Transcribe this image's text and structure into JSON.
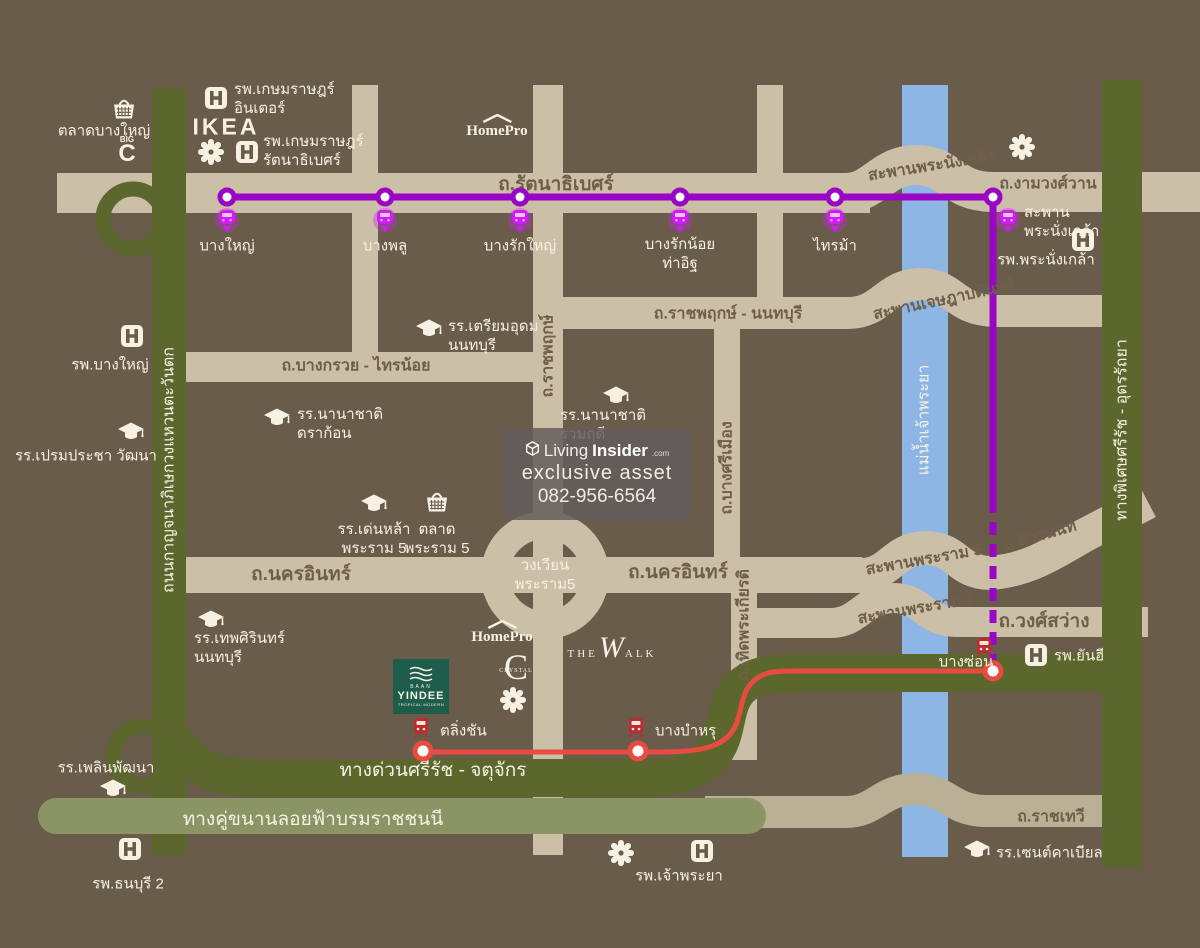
{
  "map": {
    "colors": {
      "bg": "#6a5c4b",
      "road_tan": "#cbc0a7",
      "road_label": "#6e5f4b",
      "green_dark": "#5c672d",
      "green_light": "#8a9465",
      "tan_bridge": "#b9b096",
      "river": "#8db6e5",
      "purple": "#9b05c6",
      "magenta": "#cf1df2",
      "red": "#e84b40",
      "red_dark": "#bf2a2e",
      "white": "#f7f1e4",
      "yindee": "#1e5c4b"
    },
    "watermark": {
      "brand_living": "Living",
      "brand_insider": "Insider",
      "brand_tld": ".com",
      "line2": "exclusive asset",
      "phone": "082-956-6564"
    },
    "brands": {
      "ikea": "IKEA",
      "homepro": "HomePro",
      "the_walk": [
        "THE",
        "W",
        "ALK"
      ],
      "crystal": [
        "C",
        "CRYSTAL"
      ],
      "bigc": [
        "BIG",
        "C"
      ],
      "yindee": [
        "BAAN",
        "YINDEE",
        "TROPICAL MODERN"
      ]
    },
    "purple_line_stations": [
      {
        "lines": [
          "บางใหญ่"
        ],
        "x": 227,
        "cy": 197,
        "pin": [
          227,
          222
        ],
        "label": [
          227,
          246
        ],
        "align": "center"
      },
      {
        "lines": [
          "บางพลู"
        ],
        "x": 385,
        "cy": 197,
        "pin": [
          385,
          222
        ],
        "label": [
          385,
          246
        ],
        "align": "center"
      },
      {
        "lines": [
          "บางรักใหญ่"
        ],
        "x": 520,
        "cy": 197,
        "pin": [
          520,
          222
        ],
        "label": [
          520,
          246
        ],
        "align": "center"
      },
      {
        "lines": [
          "บางรักน้อย",
          "ท่าอิฐ"
        ],
        "x": 680,
        "cy": 197,
        "pin": [
          680,
          222
        ],
        "label": [
          680,
          254
        ],
        "align": "center"
      },
      {
        "lines": [
          "ไทรม้า"
        ],
        "x": 835,
        "cy": 197,
        "pin": [
          835,
          222
        ],
        "label": [
          835,
          246
        ],
        "align": "center"
      },
      {
        "lines": [
          "สะพาน",
          "พระนั่งเกล้า"
        ],
        "x": 993,
        "cy": 197,
        "pin": [
          1008,
          222
        ],
        "label": [
          1024,
          222
        ],
        "align": "left"
      }
    ],
    "red_line_stations": [
      {
        "lines": [
          "ตลิ่งชัน"
        ],
        "cx": 423,
        "cy": 751,
        "train": [
          421,
          728
        ],
        "label": [
          440,
          731
        ],
        "align": "left"
      },
      {
        "lines": [
          "บางบำหรุ"
        ],
        "cx": 638,
        "cy": 751,
        "train": [
          636,
          728
        ],
        "label": [
          655,
          731
        ],
        "align": "left"
      },
      {
        "lines": [
          "บางซ่อน"
        ],
        "cx": 993,
        "cy": 671,
        "train": [
          984,
          648
        ],
        "label": [
          966,
          662
        ],
        "align": "center"
      }
    ],
    "road_labels": [
      {
        "text": "ถ.รัตนาธิเบศร์",
        "x": 556,
        "y": 184,
        "rot": 0,
        "cls": "big"
      },
      {
        "text": "สะพานพระนั่งเกล้า",
        "x": 932,
        "y": 166,
        "rot": -9,
        "cls": ""
      },
      {
        "text": "ถ.งามวงศ์วาน",
        "x": 1048,
        "y": 184,
        "rot": 0,
        "cls": ""
      },
      {
        "text": "ถ.ราชพฤกษ์ - นนทบุรี",
        "x": 728,
        "y": 314,
        "rot": 0,
        "cls": ""
      },
      {
        "text": "สะพานเจษฎาบดินทร์",
        "x": 944,
        "y": 300,
        "rot": -12,
        "cls": ""
      },
      {
        "text": "ถ.บางกรวย - ไทรน้อย",
        "x": 356,
        "y": 366,
        "rot": 0,
        "cls": ""
      },
      {
        "text": "ถ.ราชพฤกษ์",
        "x": 548,
        "y": 356,
        "rot": -90,
        "cls": ""
      },
      {
        "text": "ถ.บางศรีเมือง",
        "x": 727,
        "y": 468,
        "rot": -90,
        "cls": ""
      },
      {
        "text": "ถ.นครอินทร์",
        "x": 301,
        "y": 574,
        "rot": 0,
        "cls": "big"
      },
      {
        "text": "ถ.นครอินทร์",
        "x": 678,
        "y": 572,
        "rot": 0,
        "cls": "big"
      },
      {
        "text": "สะพานพระราม 5",
        "x": 924,
        "y": 560,
        "rot": -10,
        "cls": ""
      },
      {
        "text": "ถ.ติวานนท์",
        "x": 1040,
        "y": 536,
        "rot": -16,
        "cls": ""
      },
      {
        "text": "สะพานพระราม 7",
        "x": 916,
        "y": 609,
        "rot": -10,
        "cls": ""
      },
      {
        "text": "ถ.วงศ์สว่าง",
        "x": 1044,
        "y": 621,
        "rot": 0,
        "cls": "big"
      },
      {
        "text": "ถ.เทิดพระเกียรติ",
        "x": 744,
        "y": 625,
        "rot": -90,
        "cls": ""
      },
      {
        "text": "ทางด่วนศรีรัช - จตุจักร",
        "x": 433,
        "y": 770,
        "rot": 0,
        "cls": "white big"
      },
      {
        "text": "ทางคู่ขนานลอยฟ้าบรมราชชนนี",
        "x": 313,
        "y": 819,
        "rot": 0,
        "cls": "white big"
      },
      {
        "text": "ถ.ราชเทวี",
        "x": 1051,
        "y": 817,
        "rot": 0,
        "cls": ""
      },
      {
        "text": "ถนนกาญจนาภิเษกวงแหวนตะวันตก",
        "x": 169,
        "y": 470,
        "rot": -90,
        "cls": "white"
      },
      {
        "text": "ทางพิเศษศรีรัช - อุดรรัถยา",
        "x": 1122,
        "y": 430,
        "rot": -90,
        "cls": "white"
      },
      {
        "text": "แม่น้ำเจ้าพระยา",
        "x": 924,
        "y": 420,
        "rot": -90,
        "cls": "white"
      }
    ],
    "roundabout": {
      "lines": [
        "วงเวียน",
        "พระราม5"
      ],
      "x": 545,
      "y": 575
    },
    "pois": [
      {
        "icons": [
          {
            "t": "market",
            "x": 124,
            "y": 108
          }
        ],
        "lines": [
          "ตลาดบางใหญ่"
        ],
        "label": [
          104,
          131
        ],
        "align": "center"
      },
      {
        "icons": [
          {
            "t": "hospital",
            "x": 216,
            "y": 98
          }
        ],
        "lines": [
          "รพ.เกษมราษฎร์",
          "อินเตอร์"
        ],
        "label": [
          234,
          99
        ],
        "align": "left"
      },
      {
        "icons": [
          {
            "t": "flower",
            "x": 211,
            "y": 152
          },
          {
            "t": "hospital",
            "x": 247,
            "y": 152
          }
        ],
        "lines": [
          "รพ.เกษมราษฎร์",
          "รัตนาธิเบศร์"
        ],
        "label": [
          263,
          151
        ],
        "align": "left"
      },
      {
        "icons": [
          {
            "t": "hospital",
            "x": 132,
            "y": 336
          }
        ],
        "lines": [
          "รพ.บางใหญ่"
        ],
        "label": [
          110,
          365
        ],
        "align": "center"
      },
      {
        "icons": [
          {
            "t": "school",
            "x": 131,
            "y": 432
          }
        ],
        "lines": [
          "รร.เปรมประชา วัฒนา"
        ],
        "label": [
          86,
          456
        ],
        "align": "center"
      },
      {
        "icons": [
          {
            "t": "school",
            "x": 429,
            "y": 329
          }
        ],
        "lines": [
          "รร.เตรียมอุดม",
          "นนทบุรี"
        ],
        "label": [
          448,
          336
        ],
        "align": "left"
      },
      {
        "icons": [
          {
            "t": "school",
            "x": 277,
            "y": 418
          }
        ],
        "lines": [
          "รร.นานาชาติ",
          "ดราก้อน"
        ],
        "label": [
          297,
          424
        ],
        "align": "left"
      },
      {
        "icons": [
          {
            "t": "school",
            "x": 616,
            "y": 396
          }
        ],
        "lines": [
          "รร.นานาชาติ",
          "รวมฤดี"
        ],
        "label": [
          560,
          425
        ],
        "align": "left"
      },
      {
        "icons": [
          {
            "t": "school",
            "x": 374,
            "y": 504
          }
        ],
        "lines": [
          "รร.เด่นหล้า",
          "พระราม 5"
        ],
        "label": [
          374,
          539
        ],
        "align": "center"
      },
      {
        "icons": [
          {
            "t": "market",
            "x": 437,
            "y": 501
          }
        ],
        "lines": [
          "ตลาด",
          "พระราม 5"
        ],
        "label": [
          437,
          539
        ],
        "align": "center"
      },
      {
        "icons": [
          {
            "t": "school",
            "x": 211,
            "y": 620
          }
        ],
        "lines": [
          "รร.เทพศิรินทร์",
          "นนทบุรี"
        ],
        "label": [
          194,
          648
        ],
        "align": "left"
      },
      {
        "icons": [
          {
            "t": "hospital",
            "x": 1036,
            "y": 655
          }
        ],
        "lines": [
          "รพ.ยันฮี"
        ],
        "label": [
          1054,
          656
        ],
        "align": "left"
      },
      {
        "icons": [
          {
            "t": "hospital",
            "x": 1083,
            "y": 240
          }
        ],
        "lines": [
          "รพ.พระนั่งเกล้า"
        ],
        "label": [
          1046,
          260
        ],
        "align": "center"
      },
      {
        "icons": [
          {
            "t": "flower",
            "x": 621,
            "y": 853
          },
          {
            "t": "hospital",
            "x": 702,
            "y": 851
          }
        ],
        "lines": [
          "รพ.เจ้าพระยา"
        ],
        "label": [
          679,
          876
        ],
        "align": "center"
      },
      {
        "icons": [
          {
            "t": "school",
            "x": 977,
            "y": 850
          }
        ],
        "lines": [
          "รร.เซนต์คาเบียล"
        ],
        "label": [
          996,
          853
        ],
        "align": "left"
      },
      {
        "icons": [
          {
            "t": "hospital",
            "x": 130,
            "y": 849
          }
        ],
        "lines": [
          "รพ.ธนบุรี 2"
        ],
        "label": [
          128,
          884
        ],
        "align": "center"
      },
      {
        "icons": [
          {
            "t": "school",
            "x": 113,
            "y": 789
          }
        ],
        "lines": [
          "รร.เพลินพัฒนา"
        ],
        "label": [
          106,
          768
        ],
        "align": "center"
      },
      {
        "icons": [
          {
            "t": "flower",
            "x": 1022,
            "y": 147
          }
        ],
        "lines": [],
        "label": [
          0,
          0
        ],
        "align": "center"
      },
      {
        "icons": [
          {
            "t": "flower",
            "x": 513,
            "y": 700
          }
        ],
        "lines": [],
        "label": [
          0,
          0
        ],
        "align": "center"
      }
    ]
  }
}
